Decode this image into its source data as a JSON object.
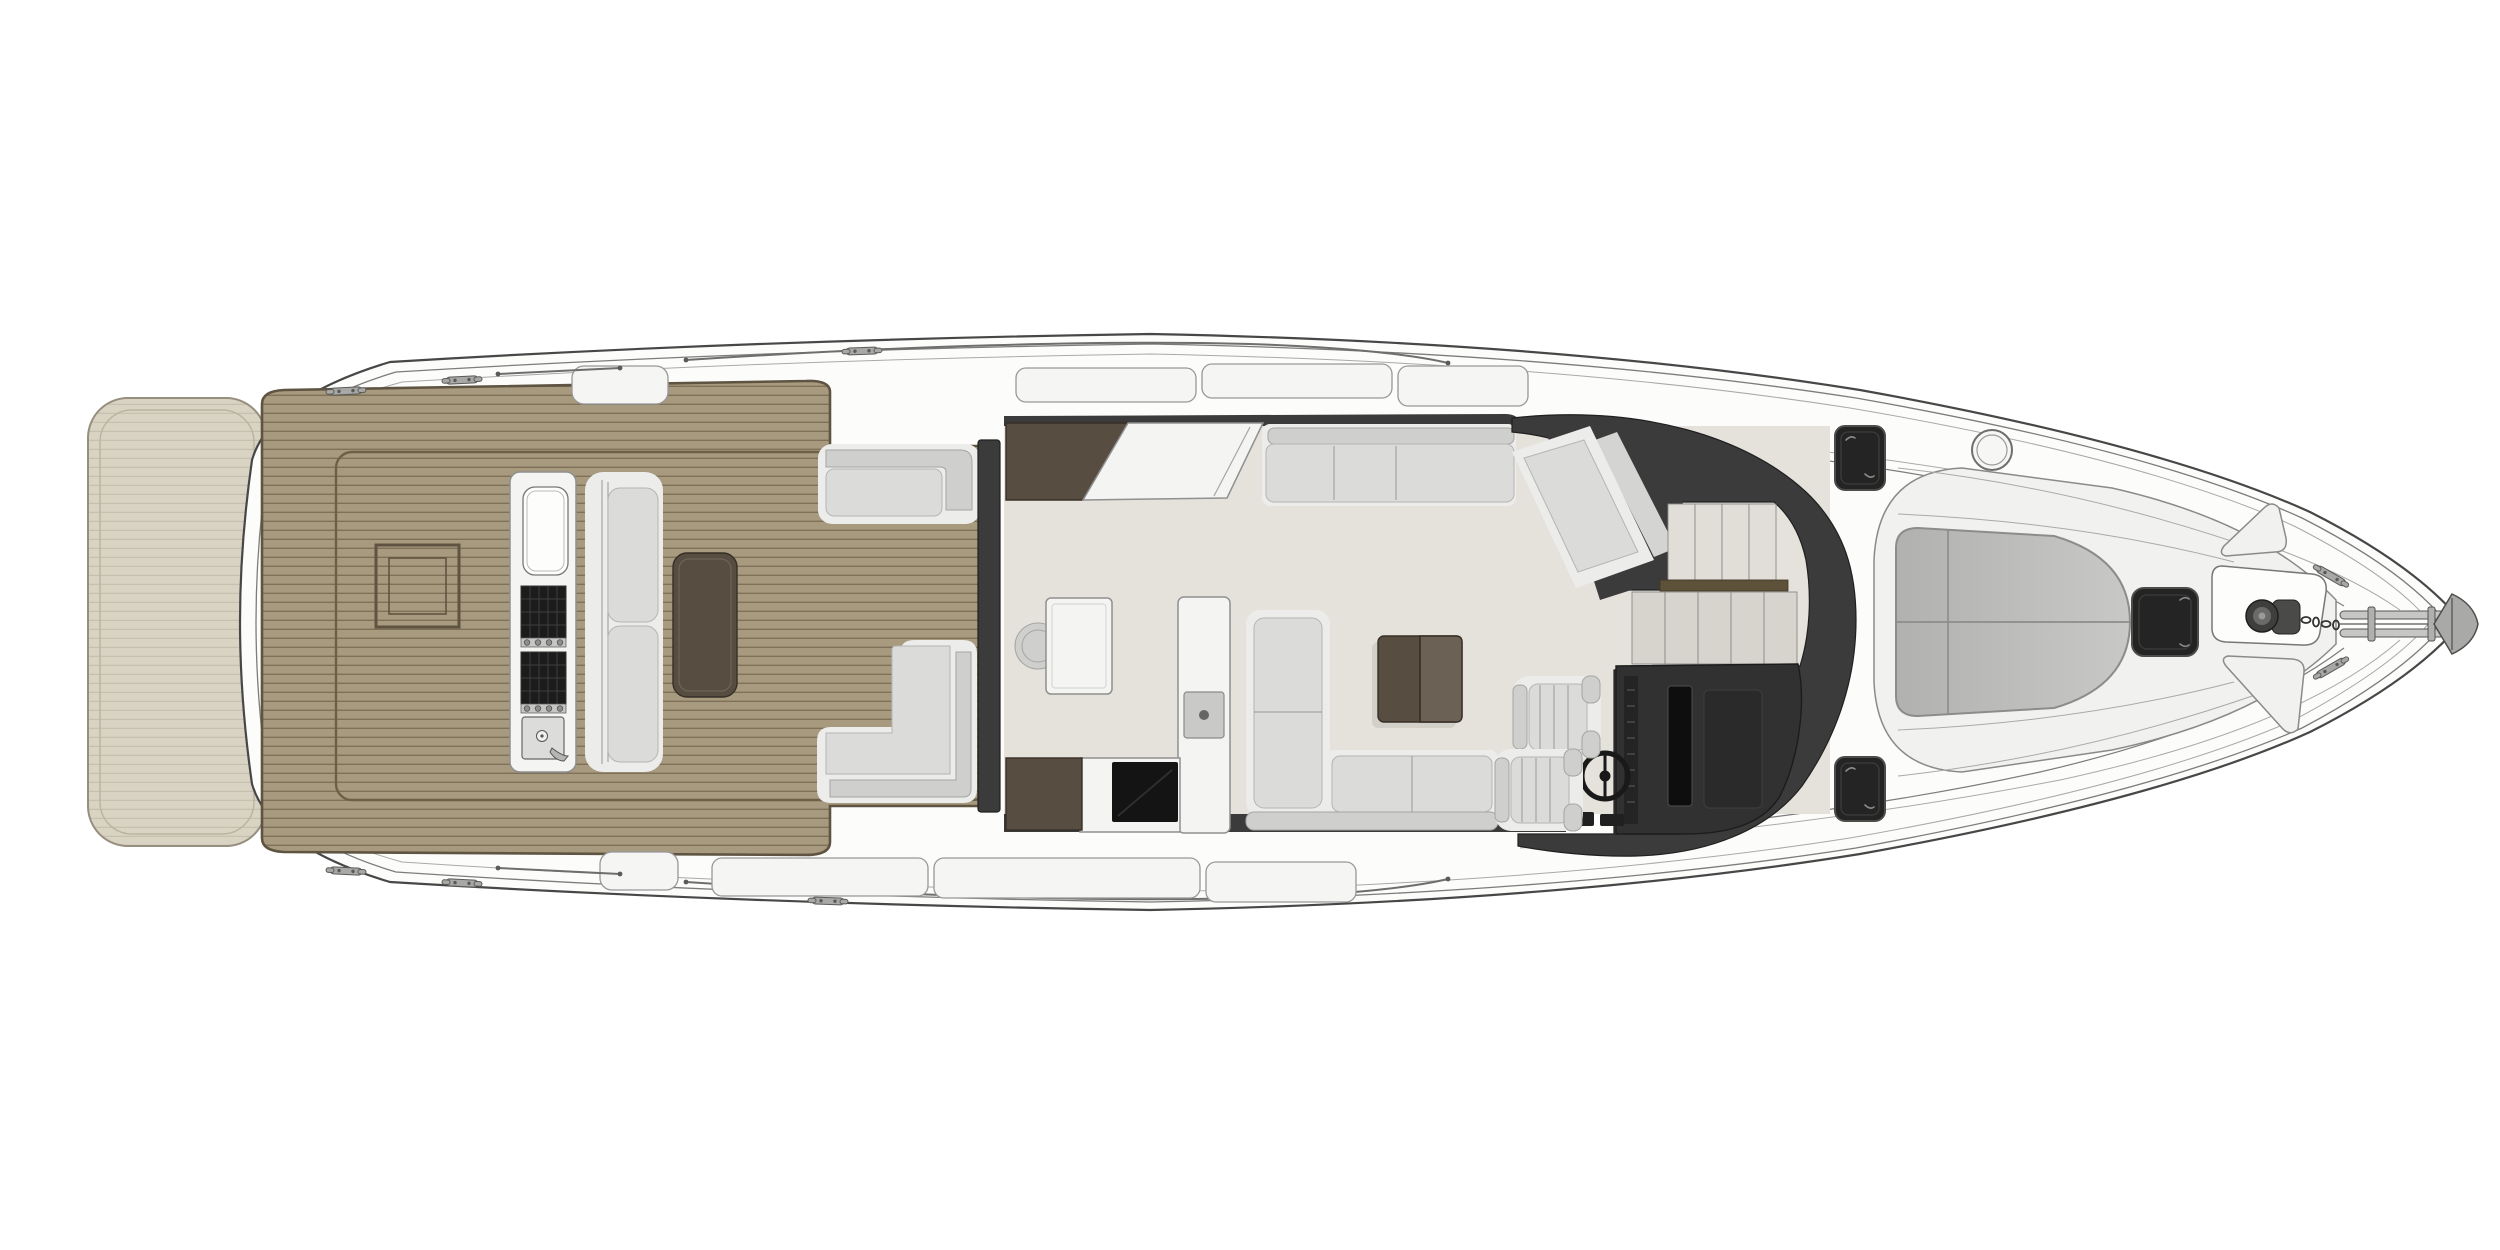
{
  "title": "Motor yacht main deck floor plan - top view",
  "colors": {
    "bg": "#ffffff",
    "hullFill": "#fcfcfb",
    "hullLine": "#474747",
    "hullLineMid": "#7c7c7a",
    "hullLineLight": "#a9a9a7",
    "platformFill": "#d8d2c2",
    "platformStripe": "#c3bba8",
    "platformBorder": "#938b79",
    "teakFill": "#a79a7e",
    "teakStripe": "#7e7158",
    "teakBorder": "#5f5442",
    "teakInner": "#6d6049",
    "salonFloor": "#e4e2db",
    "darkStructure": "#3b3b3b",
    "hatchDark": "#242424",
    "screenBlack": "#0e0e0e",
    "brownDark": "#574d41",
    "brownMid": "#6b6155",
    "railBrown": "#5e5139",
    "cushionBase": "#ececea",
    "cushionInner": "#dbdbd9",
    "cushionShade": "#cfcfcd",
    "stepLight": "#e0ded6",
    "stepDark": "#d6d4cc",
    "metal": "#a8a8a6",
    "metalDark": "#5a5a58",
    "counterWhite": "#f4f4f2",
    "applianceBlack": "#141414",
    "glass": "#d4d4d2"
  },
  "components": {
    "plan": "Motor yacht main deck floor plan",
    "hull": "Hull and side decks",
    "swim_platform": "Extended swim platform",
    "cockpit_deck": "Teak cockpit deck",
    "engine_hatch": "Engine room hatch",
    "wet_bar": "Cockpit wet bar with grills and sink",
    "grill": "Barbecue grill",
    "sink": "Wet bar sink",
    "cockpit_bench": "Cockpit lounge bench",
    "cockpit_table": "Cockpit table",
    "aft_seat_starboard": "Aft corner seat (starboard)",
    "aft_seat_port": "Aft corner L-seat (port)",
    "bulkhead": "Salon aft bulkhead / sliding door",
    "salon_floor": "Salon floor",
    "galley_counter": "Galley counter",
    "galley_island": "Galley island with cooktop",
    "appliance": "Galley appliance",
    "dinette_table": "Dinette table",
    "dinette_stool": "Round stool",
    "salon_sofa": "Salon sofa (starboard)",
    "sofa_chaise": "Angled lounge seat",
    "coffee_table": "Coffee table",
    "l_sofa": "L-shaped sofa (port)",
    "windshield": "Windshield and helm surround",
    "stairs": "Companionway stairs to lower deck",
    "stair_rail": "Stair handrail",
    "helm_console": "Helm console",
    "steering_wheel": "Steering wheel",
    "helm_seat": "Helm seat",
    "deck_hatch": "Deck hatch",
    "round_hatch": "Round deck hatch",
    "bow_sunpad": "Bow sun pad",
    "bow_hatch": "Foredeck hatch",
    "windlass": "Anchor windlass",
    "anchor": "Anchor with bow roller",
    "cleat": "Mooring cleat",
    "grab_rail": "Grab rail",
    "walkway_pad": "Side deck walkway pad",
    "foredeck_panel": "Foredeck walkway panel"
  }
}
